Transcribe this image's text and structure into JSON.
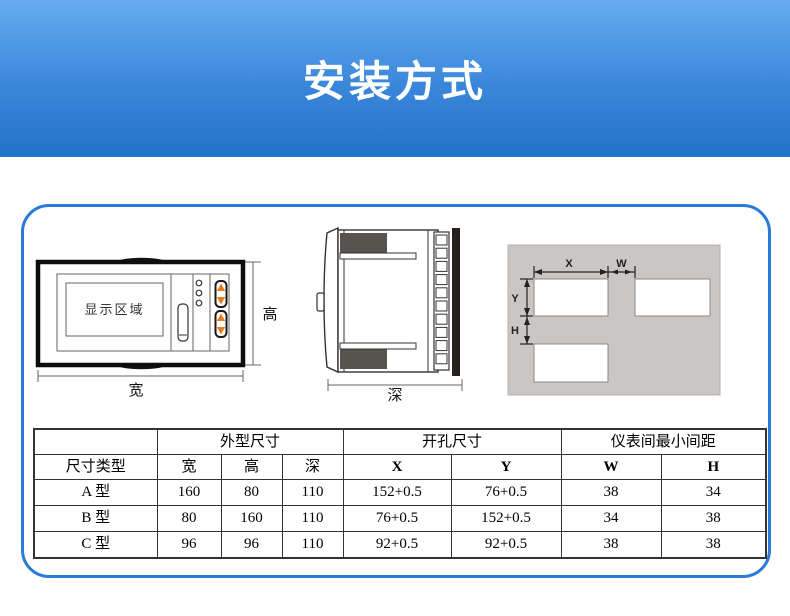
{
  "page": {
    "title": "安装方式"
  },
  "colors": {
    "banner_top": "#66acf0",
    "banner_bottom": "#2173c8",
    "box_border": "#2b7ad6",
    "panel_gray": "#c9c6c3",
    "clip_gray": "#57534e",
    "arrow_orange": "#e87d1d",
    "table_border": "#333333"
  },
  "diagrams": {
    "front_view": {
      "display_area": "显示区域",
      "height_label": "高",
      "width_label": "宽"
    },
    "side_view": {
      "depth_label": "深"
    },
    "panel_cutout": {
      "x_label": "X",
      "w_label": "W",
      "y_label": "Y",
      "h_label": "H"
    }
  },
  "table": {
    "group_headers": [
      "外型尺寸",
      "开孔尺寸",
      "仪表间最小间距"
    ],
    "column_headers": [
      "尺寸类型",
      "宽",
      "高",
      "深",
      "X",
      "Y",
      "W",
      "H"
    ],
    "rows": [
      [
        "A 型",
        "160",
        "80",
        "110",
        "152+0.5",
        "76+0.5",
        "38",
        "34"
      ],
      [
        "B 型",
        "80",
        "160",
        "110",
        "76+0.5",
        "152+0.5",
        "34",
        "38"
      ],
      [
        "C 型",
        "96",
        "96",
        "110",
        "92+0.5",
        "92+0.5",
        "38",
        "38"
      ]
    ]
  }
}
